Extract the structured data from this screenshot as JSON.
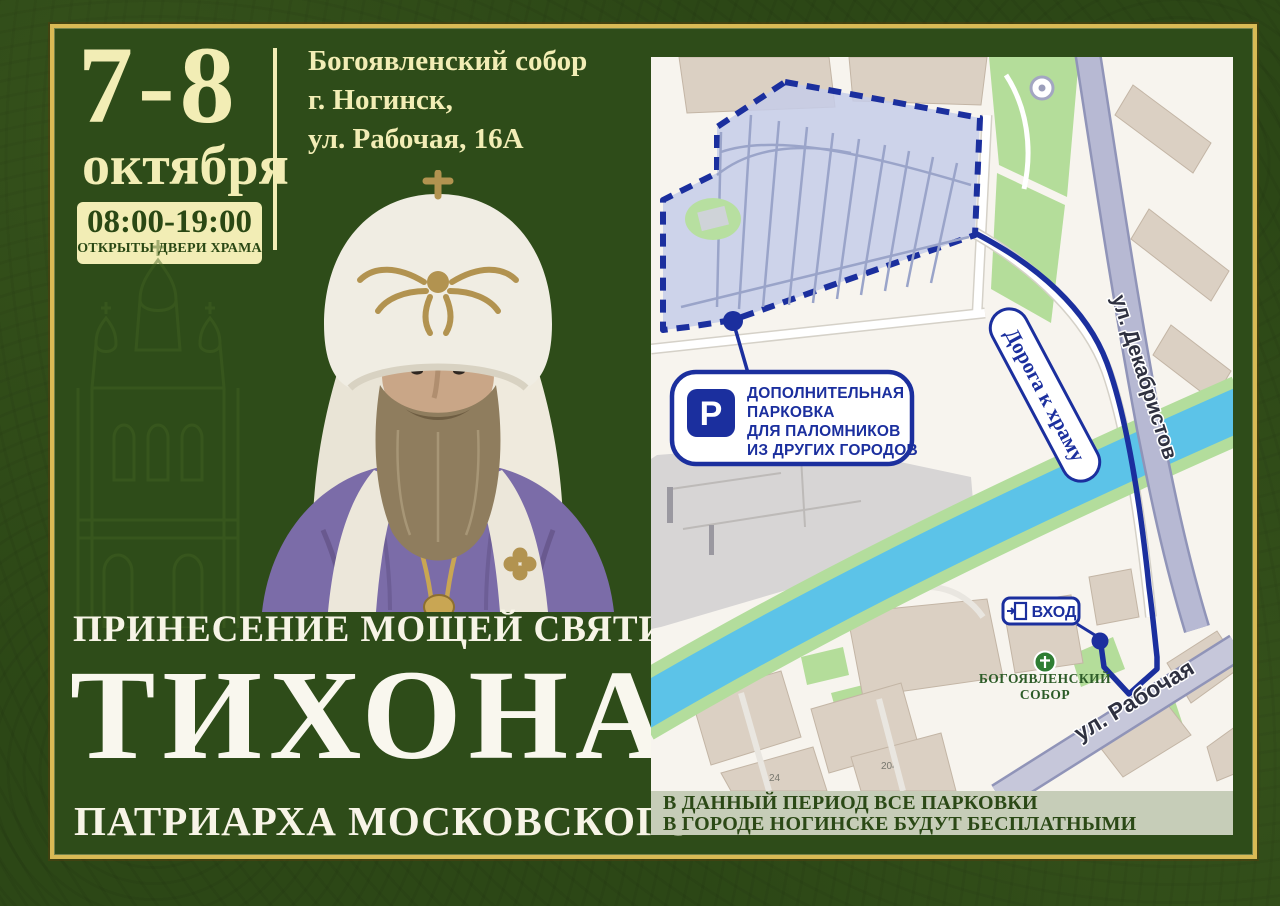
{
  "event": {
    "dates": "7-8",
    "month": "октября",
    "hours": "08:00-19:00",
    "hours_note": "ОТКРЫТЫ ДВЕРИ ХРАМА",
    "venue": {
      "line1": "Богоявленский собор",
      "line2": "г. Ногинск,",
      "line3": "ул. Рабочая, 16А"
    },
    "subtitle": "ПРИНЕСЕНИЕ МОЩЕЙ СВЯТИТЕЛЯ",
    "name": "ТИХОНА",
    "name_suffix": "ПАТРИАРХА МОСКОВСКОГО"
  },
  "map": {
    "parking_callout": {
      "icon": "P",
      "line1": "ДОПОЛНИТЕЛЬНАЯ",
      "line2": "ПАРКОВКА",
      "line3": "ДЛЯ ПАЛОМНИКОВ",
      "line4": "ИЗ ДРУГИХ ГОРОДОВ"
    },
    "route_label": "Дорога к храму",
    "street_dekabristov": "ул. Декабристов",
    "street_rabochaya": "ул. Рабочая",
    "entrance": "ВХОД",
    "cathedral": {
      "line1": "БОГОЯВЛЕНСКИЙ",
      "line2": "СОБОР"
    },
    "building_numbers": [
      "24",
      "204"
    ]
  },
  "notice": {
    "line1": "В ДАННЫЙ ПЕРИОД ВСЕ ПАРКОВКИ",
    "line2": "В ГОРОДЕ НОГИНСКЕ БУДУТ БЕСПЛАТНЫМИ"
  },
  "colors": {
    "background_green": "#2c4716",
    "panel_green": "#2e4c19",
    "frame_gold": "#d9ba55",
    "cream": "#f2edb5",
    "navy": "#1b2f9e",
    "banner_bg": "#c6cdb8",
    "river_blue": "#5cc3e8",
    "map_bg": "#f7f4ee",
    "cathedral_green": "#2e7d33"
  }
}
